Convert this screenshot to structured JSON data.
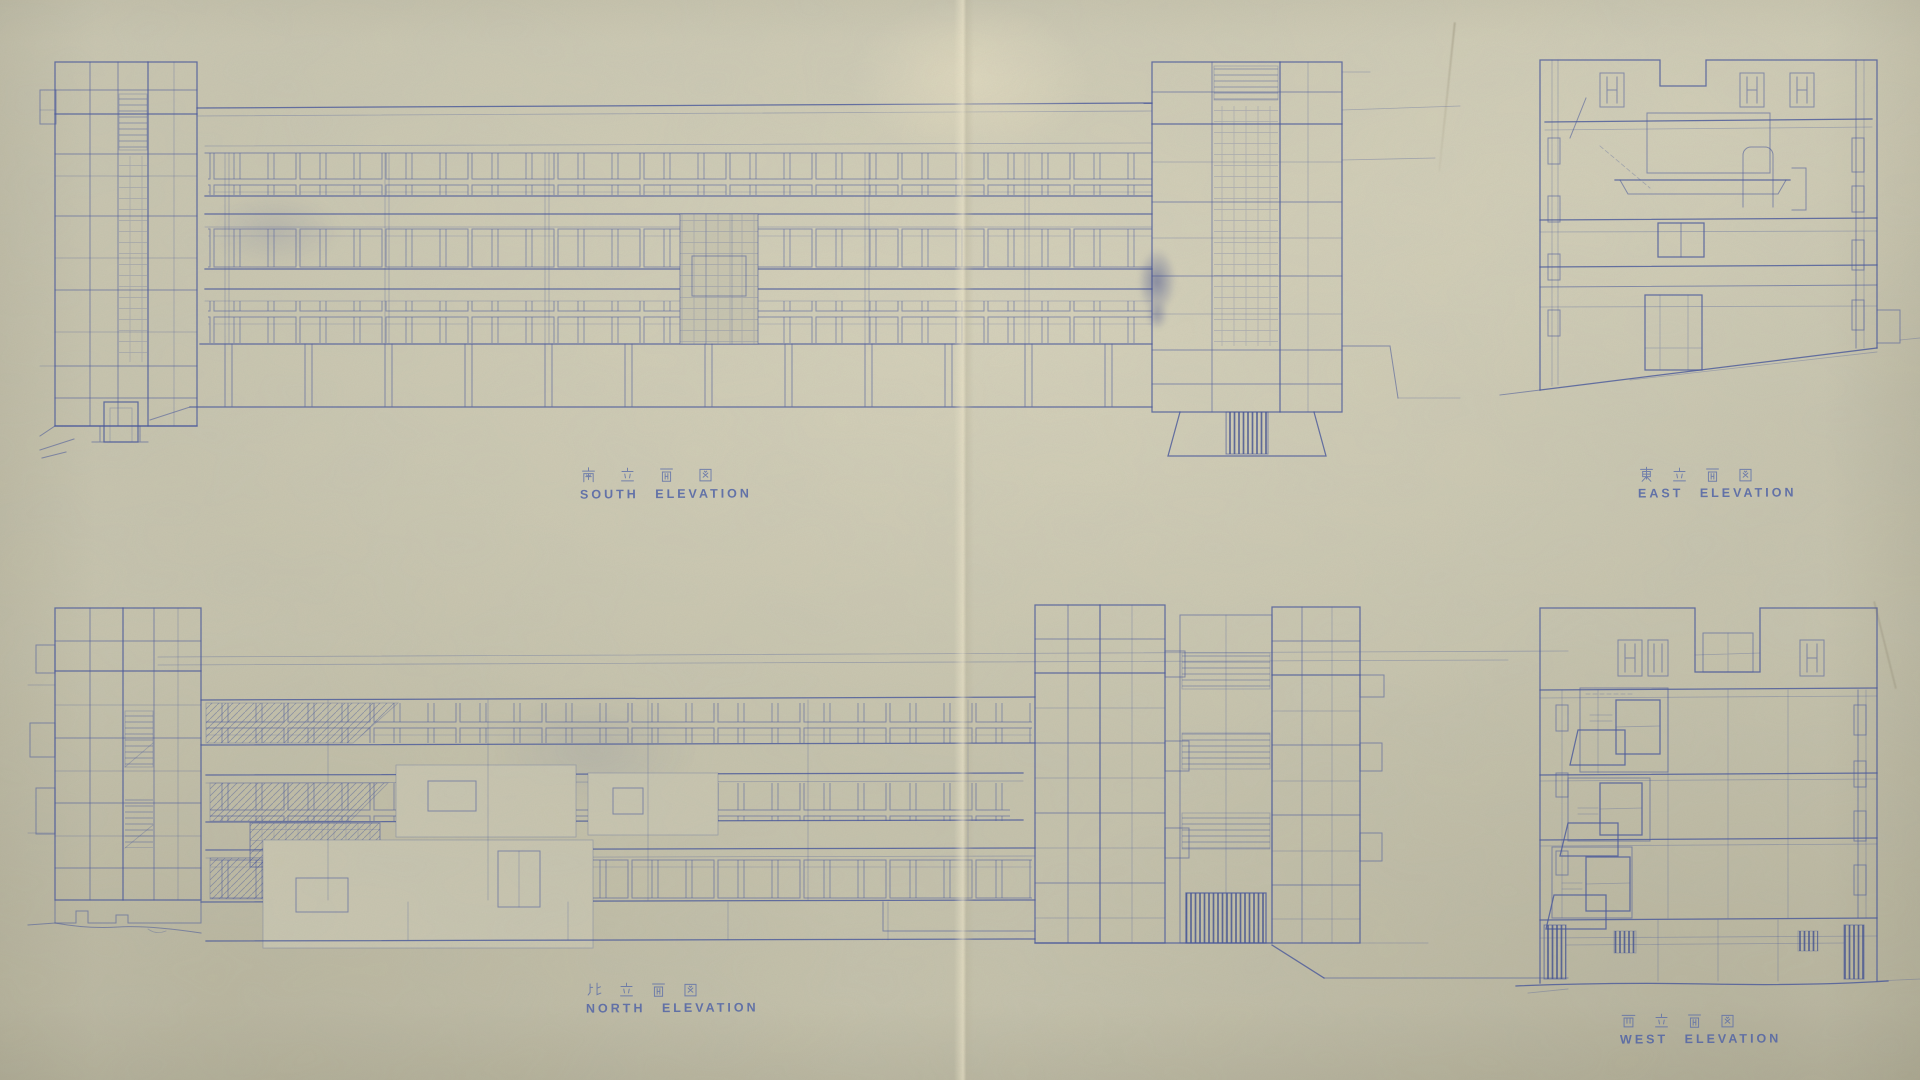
{
  "sheet": {
    "kind_note": "scanned architectural blueprint sheet, four elevations",
    "colors": {
      "paper": "#c9c6b0",
      "ink": "#46569b",
      "ink_dark": "#3c4c90",
      "fold_highlight": "#f0e8c8"
    }
  },
  "drawings": {
    "south": {
      "title_ja": "南立面図",
      "title_en": "SOUTH ELEVATION"
    },
    "east": {
      "title_ja": "東立面図",
      "title_en": "EAST ELEVATION"
    },
    "north": {
      "title_ja": "北立面図",
      "title_en": "NORTH ELEVATION"
    },
    "west": {
      "title_ja": "西立面図",
      "title_en": "WEST ELEVATION"
    }
  }
}
